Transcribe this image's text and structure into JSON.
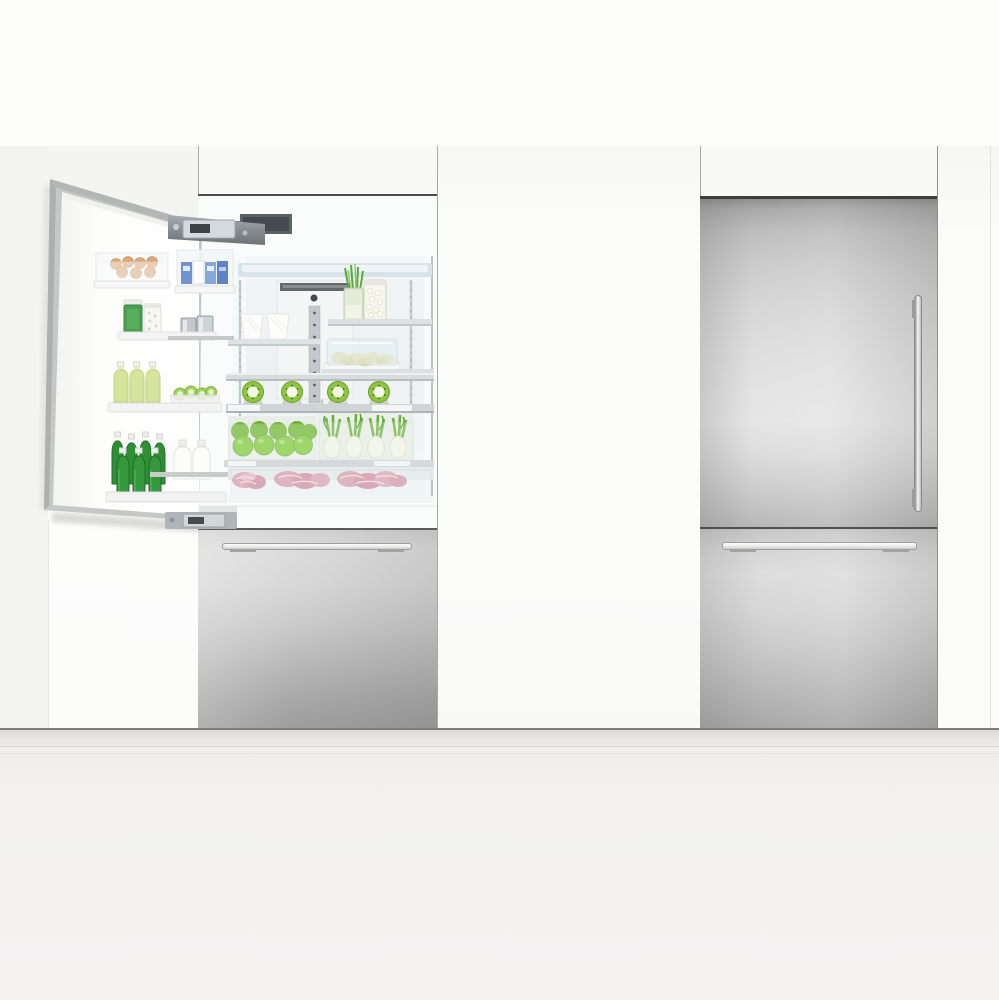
{
  "scene": {
    "description": "Product photograph: two integrated bottom-freezer refrigerators built into a white cabinetry wall — the left unit has its door open showing a stocked fresh-food interior, the right unit is closed with stainless steel panels",
    "left_fridge_label": "Open integrated refrigerator with stocked interior",
    "right_fridge_label": "Closed integrated refrigerator with stainless steel door panels",
    "open_door_label": "Open refrigerator door with storage bins",
    "interior_label": "Fresh food compartment with glass shelves",
    "left_freezer_label": "Stainless steel freezer drawer with horizontal bar handle",
    "right_upper_door_label": "Stainless steel refrigerator door with vertical bar handle",
    "right_freezer_label": "Stainless steel freezer drawer with horizontal bar handle",
    "cabinetry_label": "White panel cabinetry",
    "floor_label": "Light floor and toe-kick"
  },
  "interior_items": {
    "light_strip": "interior ceiling light strip",
    "control_tower": "rear air and temperature control column",
    "jar_spring_onions": "glass jar of spring onions",
    "jar_garlic": "glass jar of garlic cloves",
    "cups": {
      "label": "white cups on shelf",
      "count": 2
    },
    "covered_dish": "covered glass dish of food",
    "kiwis": {
      "label": "kiwi fruit halves in holders",
      "count": 4
    },
    "apples": {
      "label": "green apples in crisper bin",
      "count": 9
    },
    "fennel": {
      "label": "fennel bulbs with green stalks in crisper bin",
      "count": 4
    },
    "meat": {
      "label": "fresh meat cuts in chilled bottom drawer",
      "count": 3
    }
  },
  "door_items": {
    "eggs": {
      "label": "brown eggs in door tray",
      "count": 7
    },
    "packs": "packaged goods in clear door bin",
    "jar_green": "jar of green preserves",
    "jar_white": "jar of white preserves",
    "canisters": {
      "label": "metal canisters",
      "count": 2
    },
    "juice": {
      "label": "bottles of green juice",
      "count": 3
    },
    "limes": "basket of lime halves",
    "beer": {
      "label": "green glass bottles",
      "count": 7
    },
    "milk": {
      "label": "milk bottles",
      "count": 2
    }
  },
  "hardware": {
    "top_hinge": "articulated top door hinge",
    "bottom_hinge": "articulated bottom door hinge",
    "left_drawer_handle": "brushed steel horizontal handle",
    "right_door_handle": "brushed steel vertical handle",
    "right_drawer_handle": "brushed steel horizontal handle"
  },
  "colors": {
    "wall_upper": "#fdfdfc",
    "wall_lower": "#f3f3f2",
    "cabinet_panel": "#fbfbfa",
    "stainless_light": "#e6e6e6",
    "stainless_dark": "#9e9e9e",
    "interior_back": "#eef2f3",
    "apple_green": "#7cc832",
    "scallion_green": "#5aa83c",
    "bottle_green": "#2f8f37",
    "juice_green": "#d7e59c",
    "meat_pink": "#d98ba0",
    "handle_steel": "#e8e8e8"
  }
}
